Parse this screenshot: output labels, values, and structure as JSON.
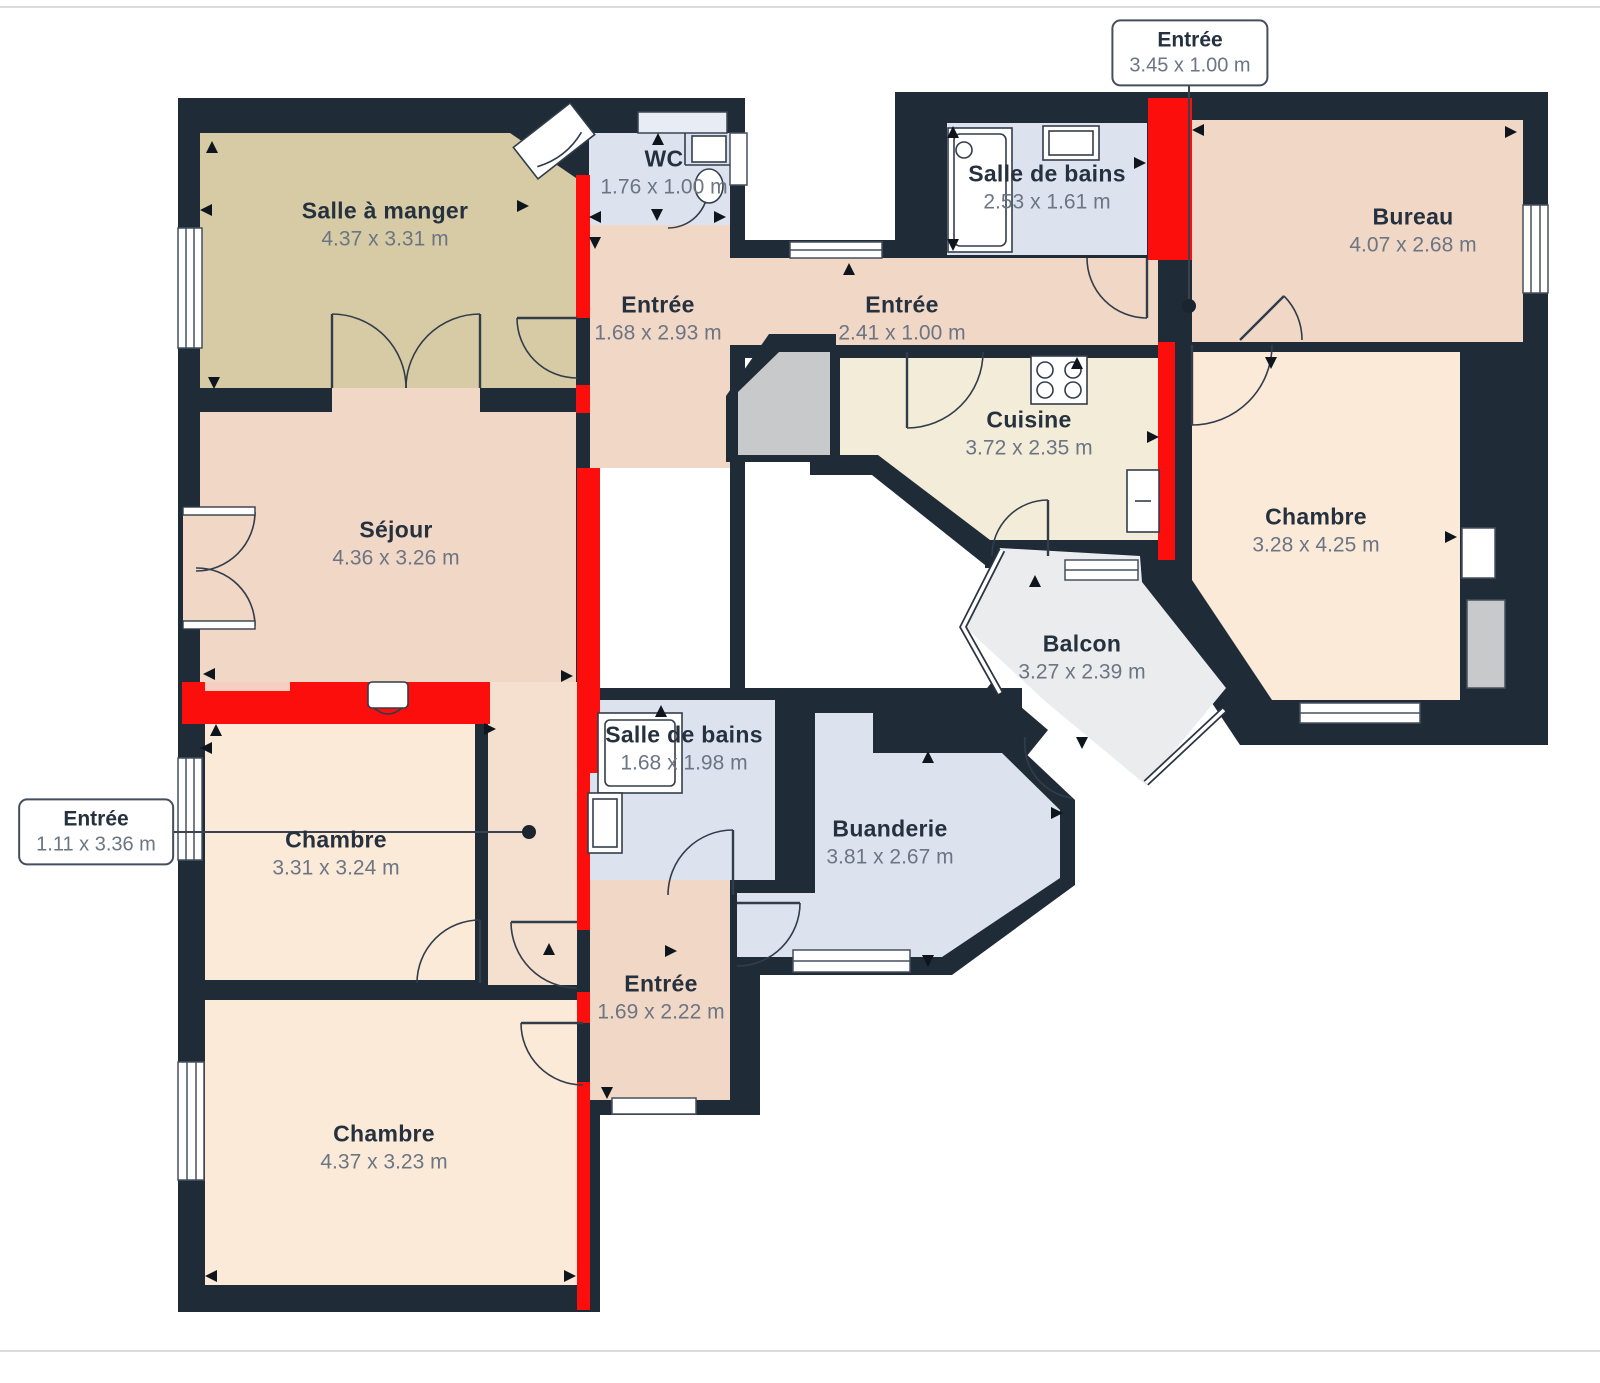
{
  "plan": {
    "rooms": [
      {
        "id": "salle-a-manger",
        "label": "Salle à manger",
        "dims": "4.37 x 3.31 m"
      },
      {
        "id": "wc",
        "label": "WC",
        "dims": "1.76 x 1.00 m"
      },
      {
        "id": "entree-haut",
        "label": "Entrée",
        "dims": "1.68 x 2.93 m"
      },
      {
        "id": "entree-couloir",
        "label": "Entrée",
        "dims": "2.41 x 1.00 m"
      },
      {
        "id": "salle-de-bains-haut",
        "label": "Salle de bains",
        "dims": "2.53 x 1.61 m"
      },
      {
        "id": "bureau",
        "label": "Bureau",
        "dims": "4.07 x 2.68 m"
      },
      {
        "id": "cuisine",
        "label": "Cuisine",
        "dims": "3.72 x 2.35 m"
      },
      {
        "id": "chambre-droite",
        "label": "Chambre",
        "dims": "3.28 x 4.25 m"
      },
      {
        "id": "sejour",
        "label": "Séjour",
        "dims": "4.36 x 3.26 m"
      },
      {
        "id": "balcon",
        "label": "Balcon",
        "dims": "3.27 x 2.39 m"
      },
      {
        "id": "salle-de-bains-milieu",
        "label": "Salle de bains",
        "dims": "1.68 x 1.98 m"
      },
      {
        "id": "buanderie",
        "label": "Buanderie",
        "dims": "3.81 x 2.67 m"
      },
      {
        "id": "chambre-gauche",
        "label": "Chambre",
        "dims": "3.31 x 3.24 m"
      },
      {
        "id": "entree-bas",
        "label": "Entrée",
        "dims": "1.69 x 2.22 m"
      },
      {
        "id": "chambre-bas",
        "label": "Chambre",
        "dims": "4.37 x 3.23 m"
      }
    ],
    "callouts": [
      {
        "id": "entree-mur-haut",
        "label": "Entrée",
        "dims": "3.45 x 1.00 m"
      },
      {
        "id": "entree-mur-gauche",
        "label": "Entrée",
        "dims": "1.11 x 3.36 m"
      }
    ],
    "palette": {
      "wall": "#202b38",
      "highlight": "#fb0e0b",
      "dining": "#d7cba5",
      "living": "#f1d7c5",
      "hallway": "#f5e0d0",
      "bedroom": "#fcead9",
      "bathroom": "#dde3ee",
      "bathroom_light": "#e8ecf5",
      "kitchen": "#f2ecd8",
      "balcony": "#eaecee",
      "closet": "#c7c9cb",
      "name_text": "#26313f",
      "dims_text": "#6b7584"
    }
  }
}
